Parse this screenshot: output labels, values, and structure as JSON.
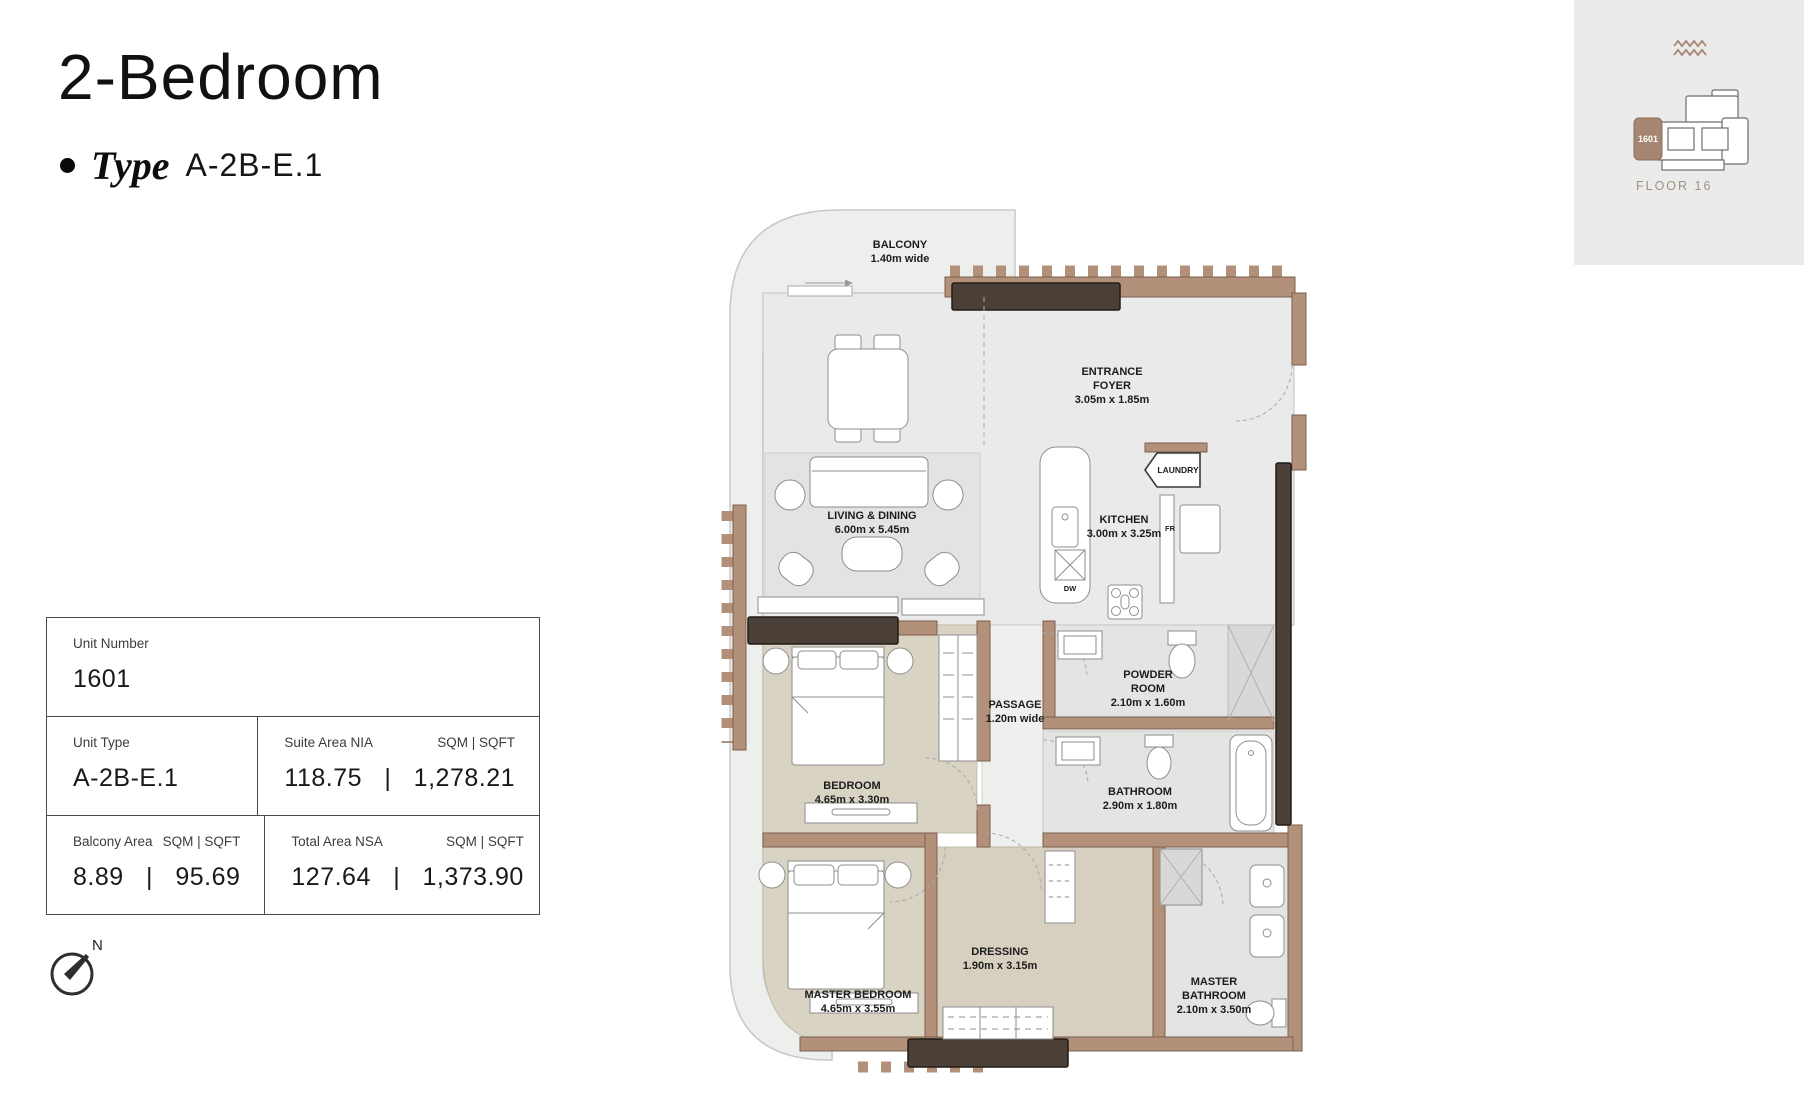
{
  "header": {
    "title": "2-Bedroom",
    "type_label": "Type",
    "type_value": "A-2B-E.1"
  },
  "info_table": {
    "unit_number": {
      "label": "Unit Number",
      "value": "1601"
    },
    "unit_type": {
      "label": "Unit Type",
      "value": "A-2B-E.1"
    },
    "suite_area": {
      "label": "Suite Area NIA",
      "units": "SQM  |  SQFT",
      "value": "118.75   |   1,278.21"
    },
    "balcony_area": {
      "label": "Balcony Area",
      "units": "SQM  |  SQFT",
      "value": "8.89   |   95.69"
    },
    "total_area": {
      "label": "Total Area NSA",
      "units": "SQM  |  SQFT",
      "value": "127.64   |   1,373.90"
    }
  },
  "plan": {
    "labels": {
      "balcony": {
        "name": "BALCONY",
        "dims": "1.40m wide"
      },
      "entrance_foyer": {
        "line1": "ENTRANCE",
        "line2": "FOYER",
        "dims": "3.05m x 1.85m"
      },
      "laundry": {
        "name": "LAUNDRY"
      },
      "kitchen": {
        "name": "KITCHEN",
        "dims": "3.00m x 3.25m"
      },
      "living_dining": {
        "name": "LIVING & DINING",
        "dims": "6.00m x 5.45m"
      },
      "passage": {
        "name": "PASSAGE",
        "dims": "1.20m wide"
      },
      "powder_room": {
        "line1": "POWDER",
        "line2": "ROOM",
        "dims": "2.10m x 1.60m"
      },
      "bedroom": {
        "name": "BEDROOM",
        "dims": "4.65m x 3.30m"
      },
      "bathroom": {
        "name": "BATHROOM",
        "dims": "2.90m x 1.80m"
      },
      "dressing": {
        "name": "DRESSING",
        "dims": "1.90m x 3.15m"
      },
      "master_bedroom": {
        "name": "MASTER BEDROOM",
        "dims": "4.65m x 3.55m"
      },
      "master_bathroom": {
        "line1": "MASTER",
        "line2": "BATHROOM",
        "dims": "2.10m x 3.50m"
      }
    },
    "appliances": {
      "fridge": "FR",
      "dishwasher": "DW"
    }
  },
  "locator": {
    "unit": "1601",
    "floor": "FLOOR 16"
  },
  "compass": {
    "north_label": "N"
  },
  "colors": {
    "wall": "#b3907a",
    "wall_outline": "#7a5f4d",
    "beam": "#4a4037",
    "floor_light": "#eaeaea",
    "floor_beige": "#d9d3c3",
    "floor_bath": "#e4e4e2",
    "balcony": "#edefed",
    "locator_bg": "#ebebeb",
    "locator_unit": "#a58672",
    "accent_text": "#a3907f"
  }
}
